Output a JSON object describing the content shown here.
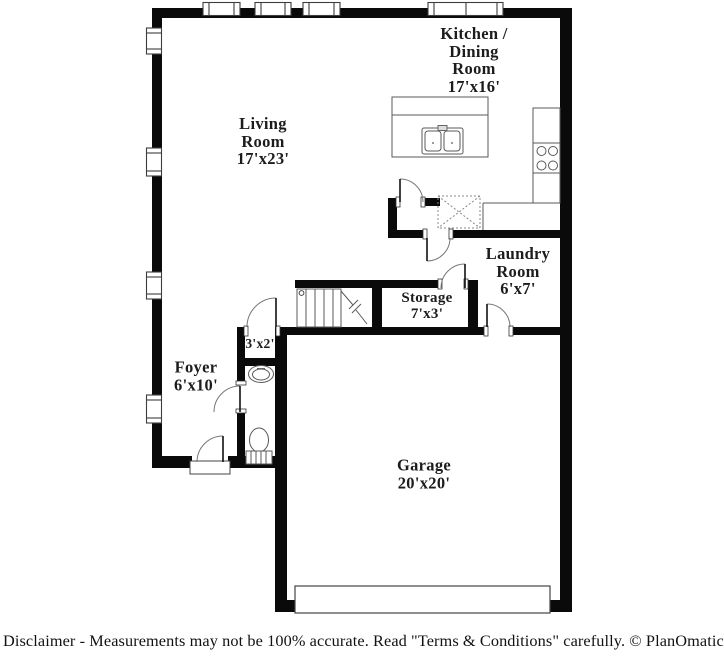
{
  "plan": {
    "rooms": {
      "kitchen": {
        "label_lines": [
          "Kitchen /",
          "Dining",
          "Room"
        ],
        "dimensions": "17'x16'"
      },
      "living": {
        "label_lines": [
          "Living",
          "Room"
        ],
        "dimensions": "17'x23'"
      },
      "laundry": {
        "label_lines": [
          "Laundry",
          "Room"
        ],
        "dimensions": "6'x7'"
      },
      "storage": {
        "label_lines": [
          "Storage"
        ],
        "dimensions": "7'x3'"
      },
      "closet": {
        "label_lines": [],
        "dimensions": "3'x2'"
      },
      "foyer": {
        "label_lines": [
          "Foyer"
        ],
        "dimensions": "6'x10'"
      },
      "garage": {
        "label_lines": [
          "Garage"
        ],
        "dimensions": "20'x20'"
      }
    },
    "fixtures": [
      "kitchen-island",
      "double-sink",
      "stove",
      "pantry",
      "staircase",
      "toilet",
      "vanity-sink",
      "garage-door",
      "front-door"
    ],
    "colors": {
      "wall": "#0a0a0a",
      "fixture_line": "#5a5a5a",
      "label_text": "#1c1c1c",
      "background": "#ffffff"
    }
  },
  "footer": {
    "disclaimer": "Disclaimer - Measurements may not be 100% accurate. Read \"Terms & Conditions\" carefully. © PlanOmatic"
  }
}
